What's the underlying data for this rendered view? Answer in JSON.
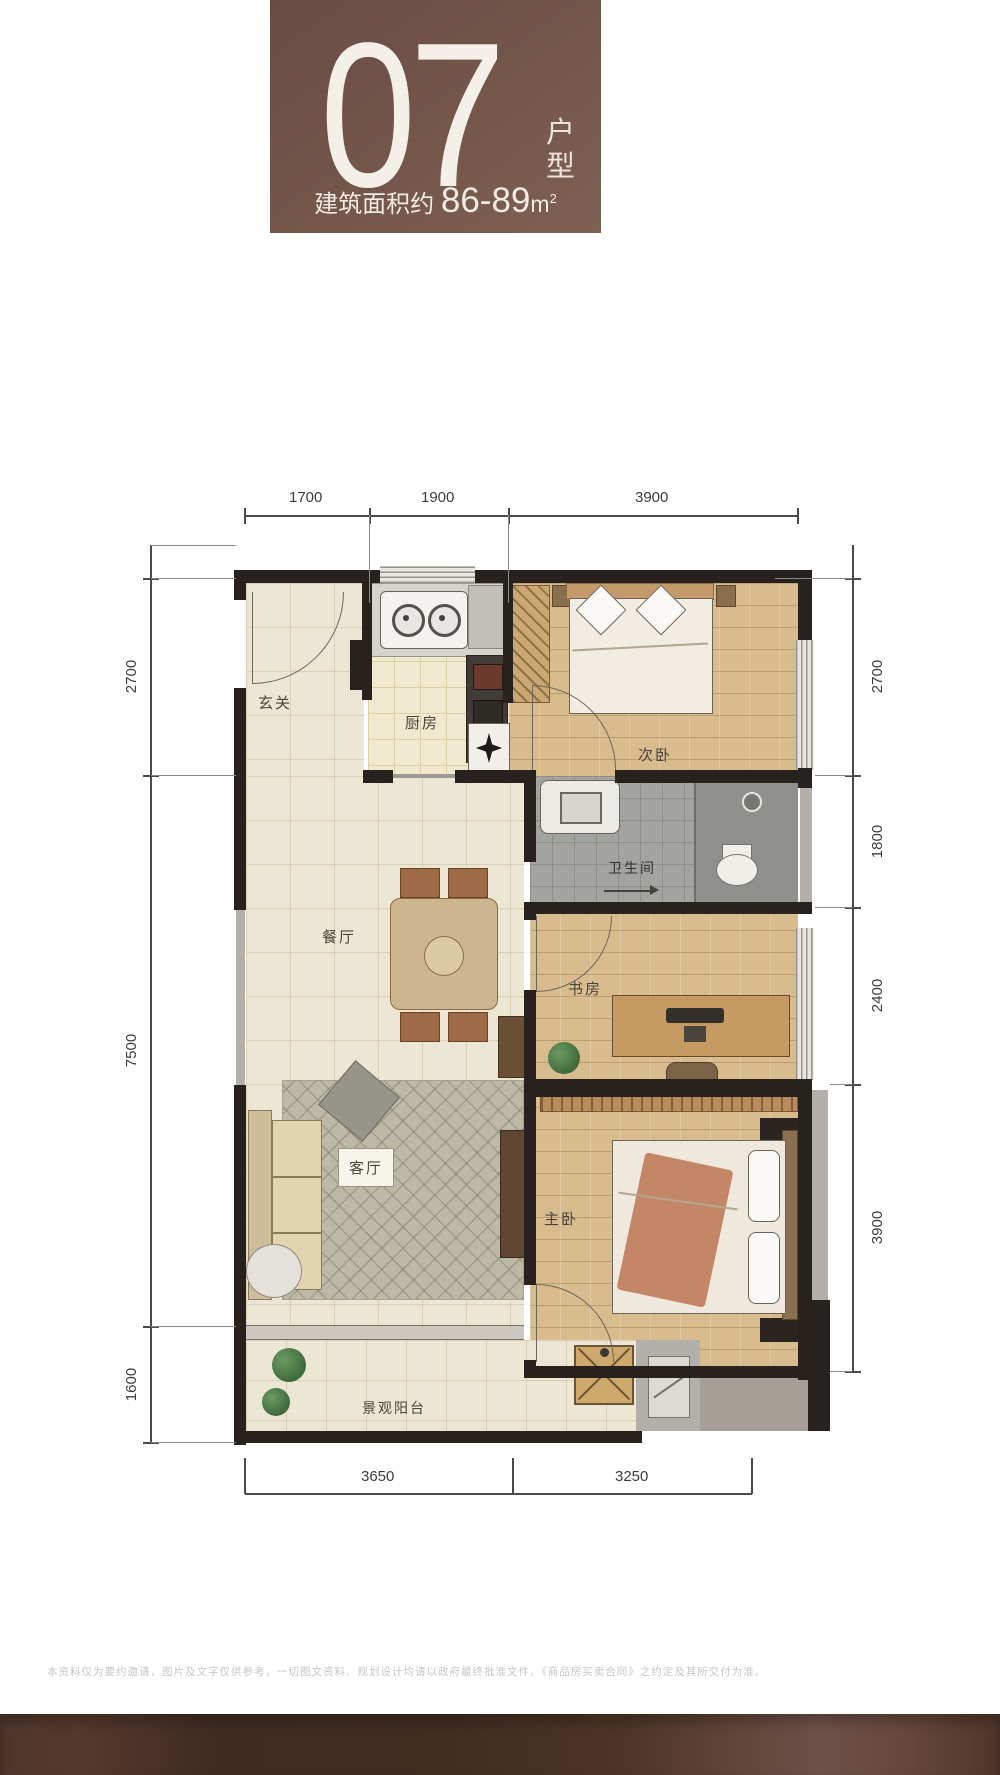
{
  "badge": {
    "unit_number": "07",
    "unit_type_chars": [
      "户",
      "型"
    ],
    "area_prefix": "建筑面积约",
    "area_value": "86-89",
    "area_unit": "m",
    "area_exponent": "2",
    "bg_color": "#74564b",
    "text_color": "#f2ece4"
  },
  "rooms": {
    "entry": "玄关",
    "kitchen": "厨房",
    "secondary_bedroom": "次卧",
    "bathroom": "卫生间",
    "dining": "餐厅",
    "study": "书房",
    "living": "客厅",
    "master_bedroom": "主卧",
    "balcony": "景观阳台"
  },
  "dims": {
    "top": [
      "1700",
      "1900",
      "3900"
    ],
    "bottom": [
      "3650",
      "3250"
    ],
    "left": [
      "2700",
      "7500",
      "1600"
    ],
    "right": [
      "2700",
      "1800",
      "2400",
      "3900"
    ]
  },
  "footer": {
    "disclaimer": "本资料仅为要约邀请，图片及文字仅供参考，一切图文资料、规划设计均请以政府最终批准文件、《商品房买卖合同》之约定及其所交付为准。",
    "bar_color": "#4a3226"
  },
  "colors": {
    "wall": "#27221e",
    "wood_floor": "#d9bc8e",
    "tile_floor": "#ece6d5",
    "bath_floor": "#a3a39f",
    "accent_brown": "#74564b"
  }
}
